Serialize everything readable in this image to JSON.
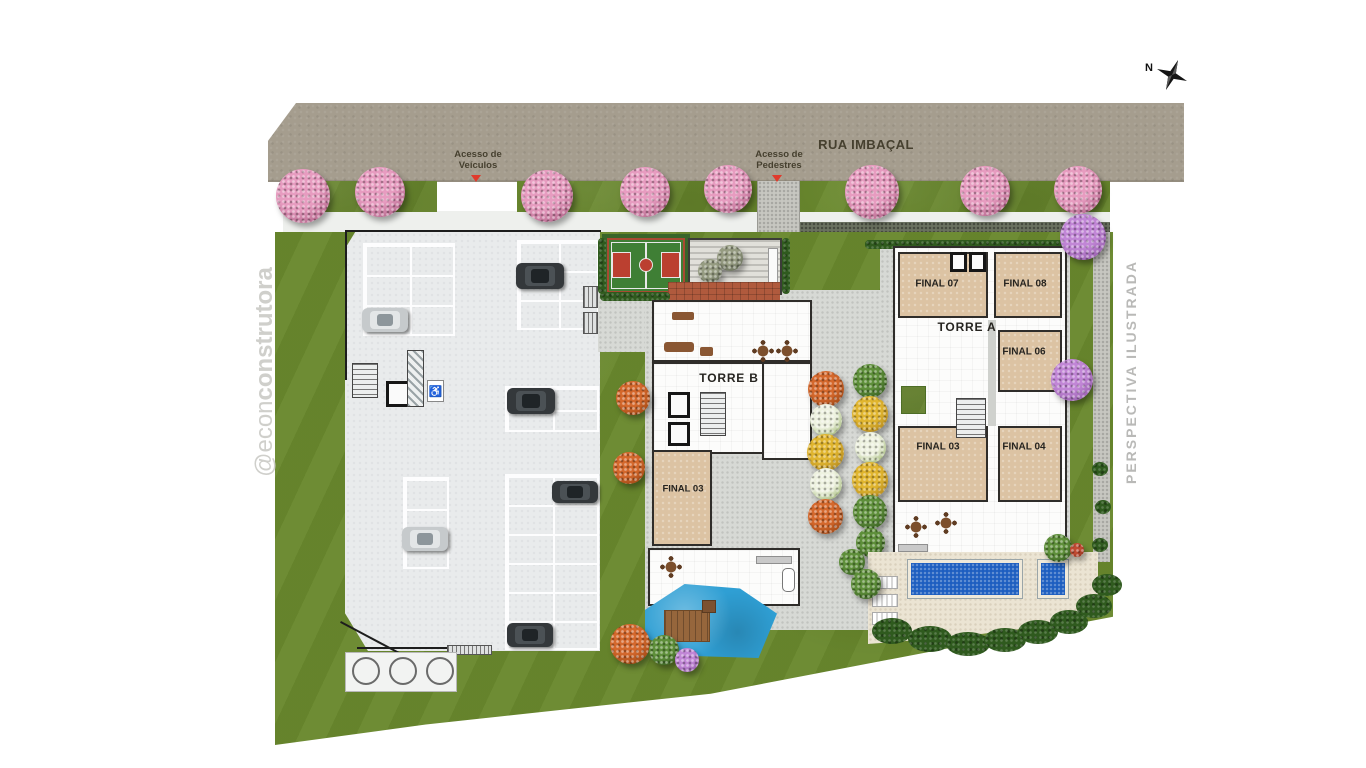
{
  "street": {
    "name": "RUA IMBAÇAL"
  },
  "access": {
    "vehicles": "Acesso de Veículos",
    "pedestrians": "Acesso de Pedestres"
  },
  "compass": {
    "north_label": "N"
  },
  "watermark": {
    "handle_light": "@econ",
    "handle_bold": "construtora"
  },
  "notes": {
    "perspective": "PERSPECTIVA ILUSTRADA"
  },
  "towers": {
    "torre_b": {
      "label": "TORRE B",
      "units": [
        {
          "label": "FINAL 03"
        }
      ]
    },
    "torre_a": {
      "label": "TORRE A",
      "units": [
        {
          "label": "FINAL 07"
        },
        {
          "label": "FINAL 08"
        },
        {
          "label": "FINAL 06"
        },
        {
          "label": "FINAL 03"
        },
        {
          "label": "FINAL 04"
        }
      ]
    }
  },
  "icons": {
    "accessible_parking": "♿"
  },
  "palette": {
    "street": "#a59d8e",
    "grass": "#69882d",
    "hedge_dark": "#2f5a1e",
    "pavement": "#d7d9d5",
    "parking_slab": "#e9ebec",
    "unit_fill": "#dcc3a3",
    "pool_blue": "#1d5ec0",
    "kids_pool_blue": "#2f9fd4",
    "court_green": "#3f7f35",
    "court_red": "#bb4030",
    "brick": "#b05a3d",
    "access_marker": "#e03a2c",
    "tree_pink": "#e79cc0",
    "tree_purple": "#c186d6"
  }
}
